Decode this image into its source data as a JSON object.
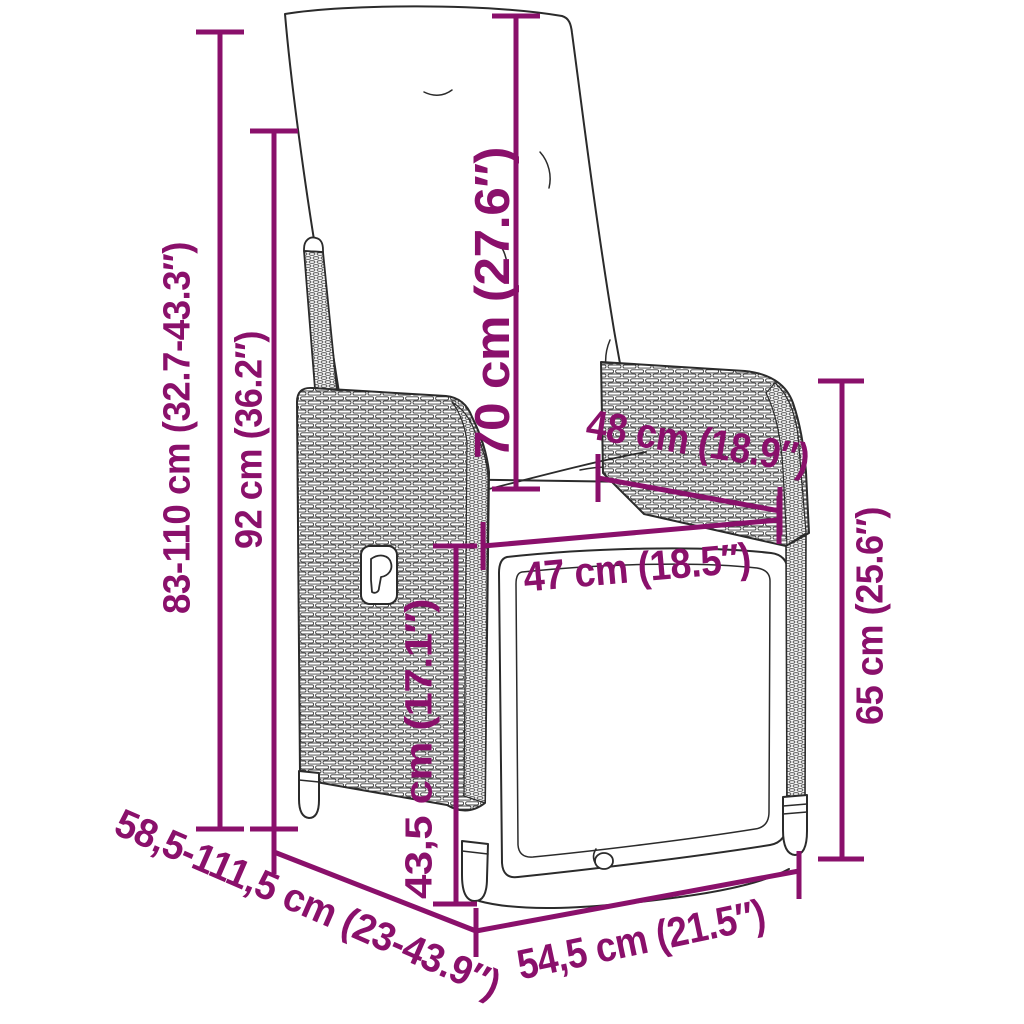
{
  "colors": {
    "dimension": "#8A106B",
    "outline": "#2B2B2B",
    "background": "#FFFFFF"
  },
  "dimensions": {
    "total_height": "83-110 cm (32.7-43.3″)",
    "backrest_height": "92 cm (36.2″)",
    "back_cushion_length": "70 cm (27.6″)",
    "armrest_depth": "48 cm (18.9″)",
    "seat_width": "47 cm (18.5″)",
    "armrest_height": "65 cm (25.6″)",
    "seat_height": "43,5 cm (17.1″)",
    "total_depth_range": "58,5-111,5 cm (23-43.9″)",
    "base_width": "54,5 cm (21.5″)"
  }
}
